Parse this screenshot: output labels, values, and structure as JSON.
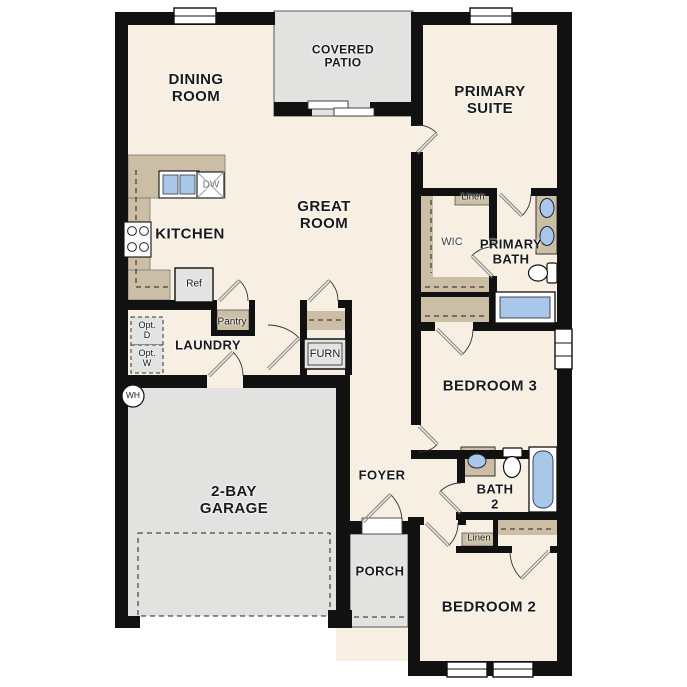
{
  "palette": {
    "wall": "#111111",
    "floor_cream": "#f6efe2",
    "outdoor_gray": "#e2e2e0",
    "cabinetry_tan": "#cbbea4",
    "fixture_blue": "#a9c7e9",
    "appliance_gray": "#e3e3e1",
    "door_leaf": "#8a8a8a"
  },
  "rooms": {
    "dining": "DINING\nROOM",
    "covered_patio": "COVERED\nPATIO",
    "primary_suite": "PRIMARY\nSUITE",
    "great_room": "GREAT\nROOM",
    "kitchen": "KITCHEN",
    "laundry": "LAUNDRY",
    "wic": "WIC",
    "primary_bath": "PRIMARY\nBATH",
    "bedroom3": "BEDROOM 3",
    "foyer": "FOYER",
    "bath2": "BATH\n2",
    "bedroom2": "BEDROOM 2",
    "porch": "PORCH",
    "garage": "2-BAY\nGARAGE"
  },
  "fixtures": {
    "linen_primary": "Linen",
    "linen_hall": "Linen",
    "pantry": "Pantry",
    "furnace": "FURN",
    "refrigerator": "Ref",
    "dishwasher": "DW",
    "water_heater": "WH",
    "opt_dryer": "Opt.\nD",
    "opt_washer": "Opt.\nW"
  }
}
